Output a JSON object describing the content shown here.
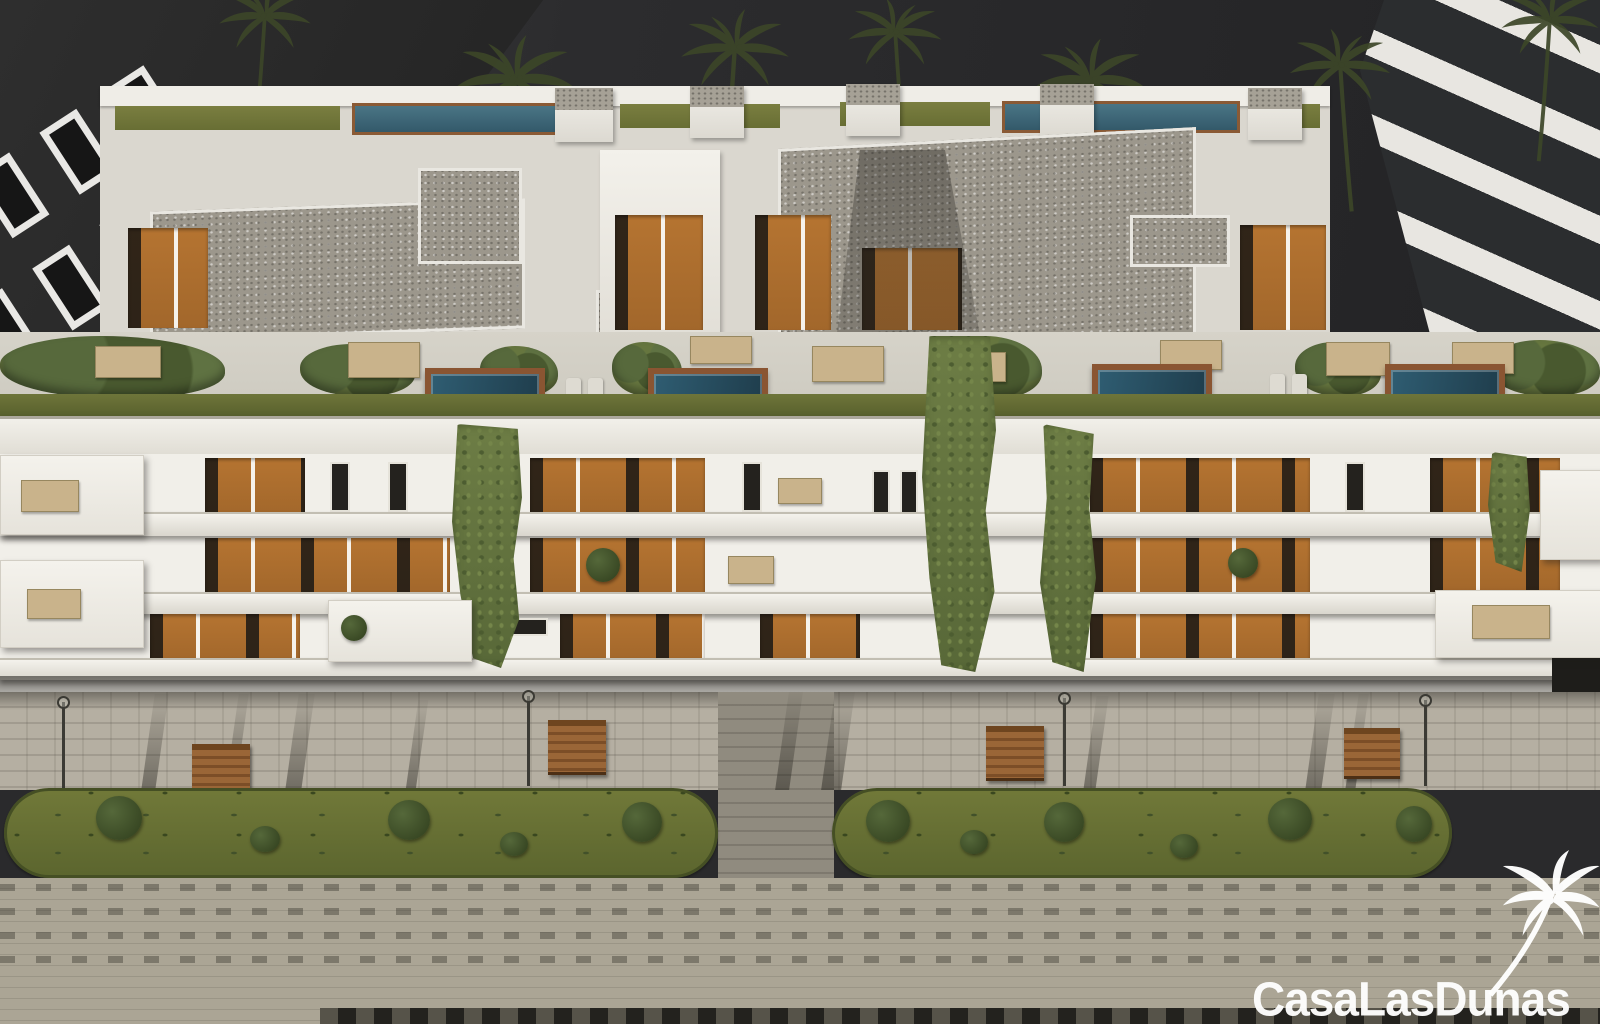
{
  "watermark": {
    "brand": "CasaLasDunas",
    "logo": "palm-tree-logo"
  },
  "scene": {
    "type": "architectural-render",
    "subject": "aerial view of a modern white apartment complex at dusk",
    "elements": [
      "dark-sky",
      "palm-tree-silhouettes",
      "dark-neighbour-building",
      "glass-neighbour-building",
      "rooftop-pool-terraces",
      "gravel-roofs",
      "roof-lawns",
      "stair-towers",
      "timber-clad-penthouses",
      "plunge-pools",
      "hedges",
      "terrace-furniture",
      "sun-loungers",
      "balcony-floors",
      "timber-balcony-walls",
      "vertical-green-walls",
      "hanging-ivy",
      "balcony-slabs",
      "street-lamps",
      "wooden-benches",
      "paved-promenade",
      "lawn-islands",
      "shrubs",
      "tree-shadows",
      "pedestrian-crossing",
      "lower-walkway"
    ]
  },
  "palette": {
    "sky": "#2c2c2e",
    "wall_white": "#f1efe9",
    "wall_shadow": "#c9c5bb",
    "gravel_roof": "#9c978c",
    "timber": "#b5742f",
    "pool_water": "#2f5d72",
    "pool_deck": "#8a5532",
    "vegetation": "#6f7f45",
    "lawn": "#6e7637",
    "pavement": "#b5afa2",
    "pavement_dark": "#8d897b",
    "dark_building": "#262626",
    "watermark": "#ffffff"
  }
}
